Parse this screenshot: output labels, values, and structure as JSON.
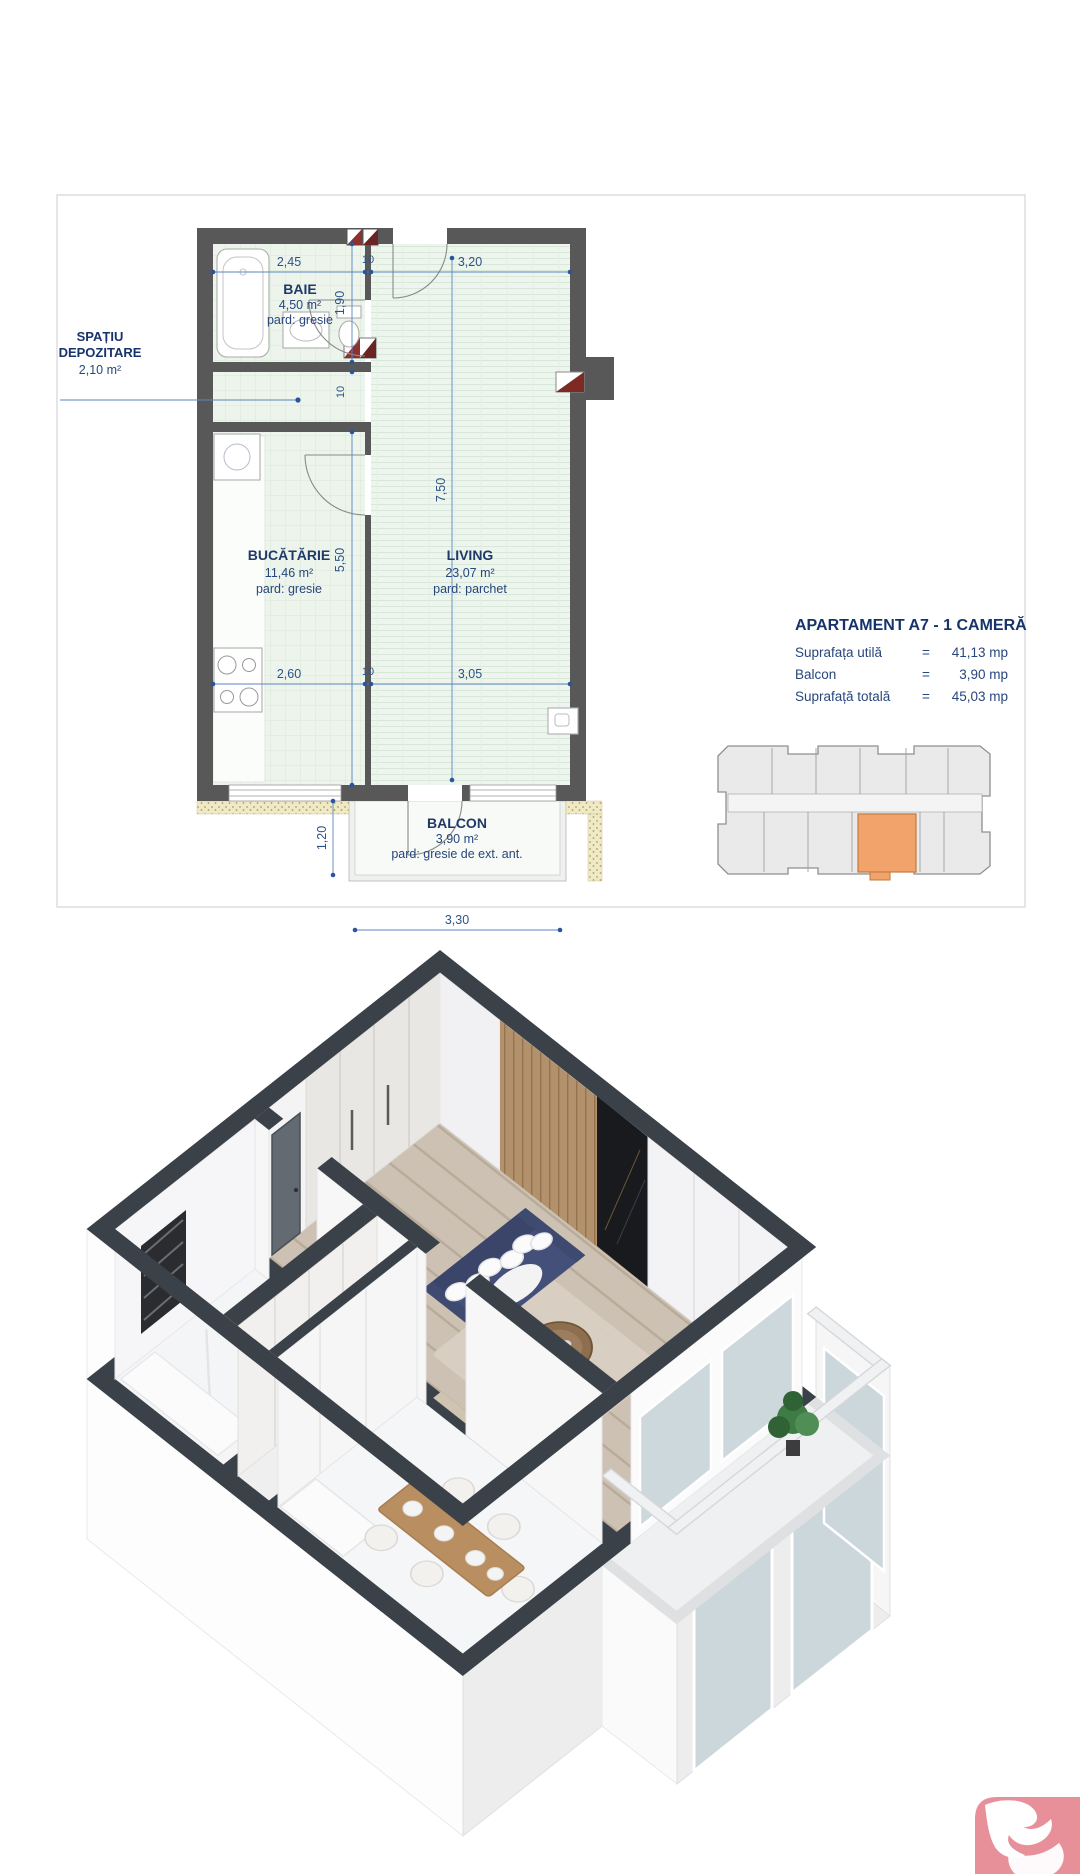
{
  "plan": {
    "rooms": {
      "baie": {
        "name": "BAIE",
        "area": "4,50 m²",
        "floor": "pard: gresie"
      },
      "depozitare": {
        "name_line1": "SPAȚIU",
        "name_line2": "DEPOZITARE",
        "area": "2,10 m²"
      },
      "bucatarie": {
        "name": "BUCĂTĂRIE",
        "area": "11,46 m²",
        "floor": "pard: gresie"
      },
      "living": {
        "name": "LIVING",
        "area": "23,07 m²",
        "floor": "pard: parchet"
      },
      "balcon": {
        "name": "BALCON",
        "area": "3,90 m²",
        "floor": "pard: gresie de ext. ant."
      }
    },
    "dims": {
      "top": [
        "2,45",
        "10",
        "3,20"
      ],
      "bottom": [
        "2,60",
        "10",
        "3,05"
      ],
      "left": [
        "1,90",
        "10",
        "5,50"
      ],
      "right": "7,50",
      "balcony_depth": "1,20",
      "balcony_width": "3,30"
    }
  },
  "info": {
    "title": "APARTAMENT A7 - 1 CAMERĂ",
    "rows": [
      {
        "label": "Suprafața utilă",
        "eq": "=",
        "value": "41,13 mp"
      },
      {
        "label": "Balcon",
        "eq": "=",
        "value": "3,90 mp"
      },
      {
        "label": "Suprafață totală",
        "eq": "=",
        "value": "45,03 mp"
      }
    ]
  },
  "colors": {
    "accent_text": "#1f3a68",
    "dim_text": "#2e5287",
    "wall_2d": "#585858",
    "floor_tint": "#ecf4ec",
    "highlight_unit": "#f2a36b",
    "wall_3d": "#3b4148",
    "logo_bg": "#e8909a"
  }
}
